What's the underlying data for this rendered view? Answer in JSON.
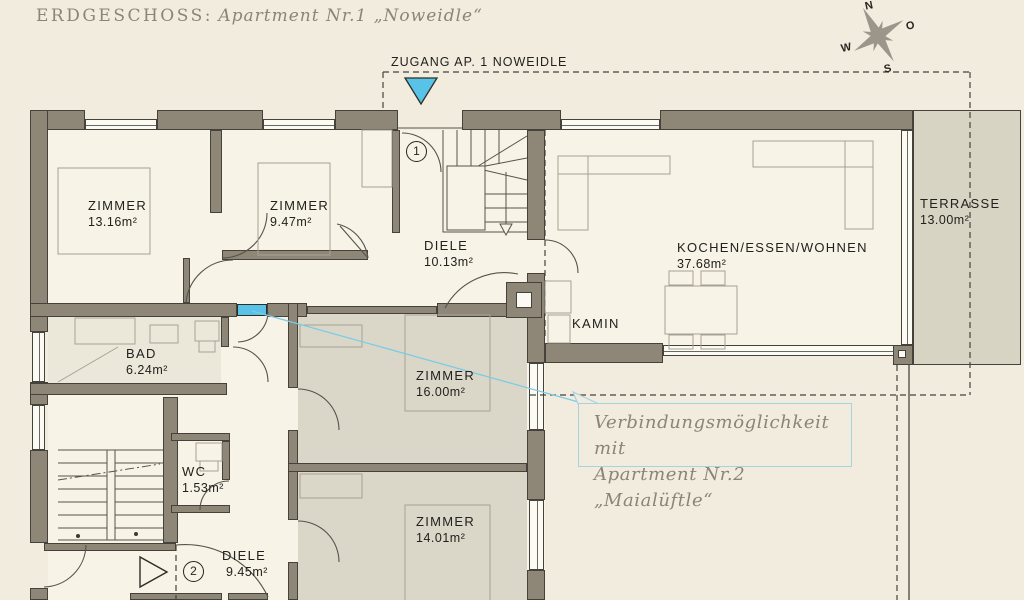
{
  "title": {
    "prefix": "ERDGESCHOSS:",
    "apartment": "Apartment Nr.1 „Noweidle“"
  },
  "entrance": {
    "label": "ZUGANG AP. 1 NOWEIDLE"
  },
  "compass": {
    "north": "N",
    "east": "O",
    "south": "S",
    "west": "W"
  },
  "rooms": {
    "zimmer1": {
      "label": "ZIMMER",
      "area": "13.16m²"
    },
    "zimmer2": {
      "label": "ZIMMER",
      "area": "9.47m²"
    },
    "diele1": {
      "label": "DIELE",
      "area": "10.13m²"
    },
    "wohnen": {
      "label": "KOCHEN/ESSEN/WOHNEN",
      "area": "37.68m²"
    },
    "terrasse": {
      "label": "TERRASSE",
      "area": "13.00m²"
    },
    "bad": {
      "label": "BAD",
      "area": "6.24m²"
    },
    "zimmer3": {
      "label": "ZIMMER",
      "area": "16.00m²"
    },
    "wc": {
      "label": "WC",
      "area": "1.53m²"
    },
    "zimmer4": {
      "label": "ZIMMER",
      "area": "14.01m²"
    },
    "diele2": {
      "label": "DIELE",
      "area": "9.45m²"
    },
    "kamin": {
      "label": "KAMIN"
    }
  },
  "markers": {
    "stairs_up": "1",
    "stairs_down": "2"
  },
  "annotation": {
    "line1": "Verbindungsmöglichkeit mit",
    "line2": "Apartment Nr.2 „Maialüftle“"
  },
  "colors": {
    "accent_cyan": "#58c3e7",
    "wall": "#8e8677",
    "terrace": "#d8d4c3"
  }
}
